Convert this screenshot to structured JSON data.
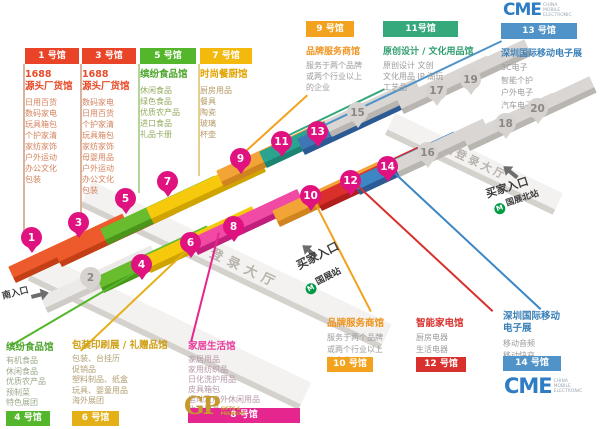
{
  "legend_top": [
    {
      "header": "1 号馆",
      "title": "1688\n源头厂货馆",
      "items": [
        "日用百货",
        "数码家电",
        "玩具箱包",
        "个护家清",
        "家纺家饰",
        "户外运动",
        "办公文化",
        "包装"
      ]
    },
    {
      "header": "3 号馆",
      "title": "1688\n源头厂货馆",
      "items": [
        "数码家电",
        "日用百货",
        "个护家清",
        "玩具箱包",
        "家纺家饰",
        "母婴用品",
        "户外运动",
        "办公文化",
        "包装"
      ]
    },
    {
      "header": "5 号馆",
      "title": "缤纷食品馆",
      "items": [
        "休闲食品",
        "绿色食品",
        "优质农产品",
        "进口食品",
        "礼品卡册"
      ]
    },
    {
      "header": "7 号馆",
      "title": "时尚餐厨馆",
      "items": [
        "厨房用品",
        "餐具",
        "陶瓷",
        "玻璃",
        "杯壶"
      ]
    }
  ],
  "hall9": {
    "header": "9 号馆",
    "title": "品牌服务商馆",
    "desc": [
      "服务于两个品牌",
      "或两个行业以上",
      "的企业"
    ]
  },
  "hall11": {
    "header": "11号馆",
    "title": "原创设计 / 文化用品馆",
    "items": [
      "原创设计  文创",
      "文化用品  IP 潮玩",
      "工艺品"
    ]
  },
  "hall13": {
    "header": "13 号馆",
    "title": "深圳国际移动电子展",
    "items": [
      "3C电子",
      "智能个护",
      "户外电子",
      "汽车电子"
    ]
  },
  "hall4": {
    "title": "缤纷食品馆",
    "items": [
      "有机食品",
      "休闲食品",
      "优质农产品",
      "预制菜",
      "特色展团"
    ],
    "label": "4 号馆"
  },
  "hall6": {
    "title": "包装印刷展 / 礼赠品馆",
    "items": [
      "包装、台挂历",
      "促销品",
      "塑料制品、纸盒",
      "玩具、婴童用品",
      "海外展团"
    ],
    "label": "6 号馆"
  },
  "hall8": {
    "title": "家居生活馆",
    "items": [
      "家居用品",
      "家用纺织品",
      "日化洗护用品",
      "皮具箱包",
      "运动及户外休闲用品",
      "收纳用品"
    ],
    "label": "8 号馆"
  },
  "hall10": {
    "title": "品牌服务商馆",
    "desc": [
      "服务于两个品牌",
      "或两个行业以上",
      "的企业"
    ],
    "label": "10 号馆"
  },
  "hall12": {
    "title": "智能家电馆",
    "items": [
      "厨房电器",
      "生活电器"
    ],
    "label": "12 号馆"
  },
  "hall14": {
    "title": "深圳国际移动\n电子展",
    "items": [
      "移动音频",
      "移动快充"
    ],
    "label": "14 号馆"
  },
  "map": {
    "south_hall": "南登录大厅",
    "north_hall": "北登录大厅",
    "south_entrance": "南入口",
    "buyer_entrance_south": "买家入口",
    "buyer_entrance_north": "买家入口",
    "metro_south": "国展站",
    "metro_north": "国展北站",
    "metro_glyph": "M",
    "pins": [
      {
        "n": "1",
        "x": 21,
        "y": 227,
        "t": "m"
      },
      {
        "n": "3",
        "x": 68,
        "y": 212,
        "t": "m"
      },
      {
        "n": "5",
        "x": 115,
        "y": 188,
        "t": "m"
      },
      {
        "n": "7",
        "x": 157,
        "y": 171,
        "t": "m"
      },
      {
        "n": "9",
        "x": 230,
        "y": 148,
        "t": "m"
      },
      {
        "n": "11",
        "x": 271,
        "y": 131,
        "t": "m"
      },
      {
        "n": "13",
        "x": 307,
        "y": 121,
        "t": "m"
      },
      {
        "n": "4",
        "x": 131,
        "y": 254,
        "t": "m"
      },
      {
        "n": "6",
        "x": 180,
        "y": 232,
        "t": "m"
      },
      {
        "n": "8",
        "x": 223,
        "y": 216,
        "t": "m"
      },
      {
        "n": "10",
        "x": 300,
        "y": 185,
        "t": "m"
      },
      {
        "n": "12",
        "x": 340,
        "y": 170,
        "t": "m"
      },
      {
        "n": "14",
        "x": 377,
        "y": 156,
        "t": "m"
      },
      {
        "n": "2",
        "x": 80,
        "y": 267,
        "t": "g"
      },
      {
        "n": "15",
        "x": 347,
        "y": 102,
        "t": "g"
      },
      {
        "n": "16",
        "x": 417,
        "y": 142,
        "t": "g"
      },
      {
        "n": "17",
        "x": 426,
        "y": 80,
        "t": "g"
      },
      {
        "n": "18",
        "x": 495,
        "y": 113,
        "t": "g"
      },
      {
        "n": "19",
        "x": 460,
        "y": 69,
        "t": "g"
      },
      {
        "n": "20",
        "x": 527,
        "y": 98,
        "t": "g"
      }
    ]
  },
  "logos": {
    "cme": "CME",
    "cme_sub": [
      "CHINA",
      "MOBILE",
      "ELECTRONIC"
    ],
    "gifts": "GP",
    "gifts_sub": [
      "GIFTS &",
      "PREMIUM"
    ]
  },
  "colors": {
    "red": "#ea4428",
    "green": "#54b72b",
    "gold": "#e4b018",
    "orange": "#f2a21d",
    "teal": "#35a87c",
    "blue": "#4f93c8",
    "magenta": "#e5268f",
    "deep_red": "#d7302d",
    "pin_magenta": "#e01280",
    "cme_blue": "#2e7cc3",
    "metro_green": "#009a44",
    "gifts_gold": "#c49a2f"
  }
}
